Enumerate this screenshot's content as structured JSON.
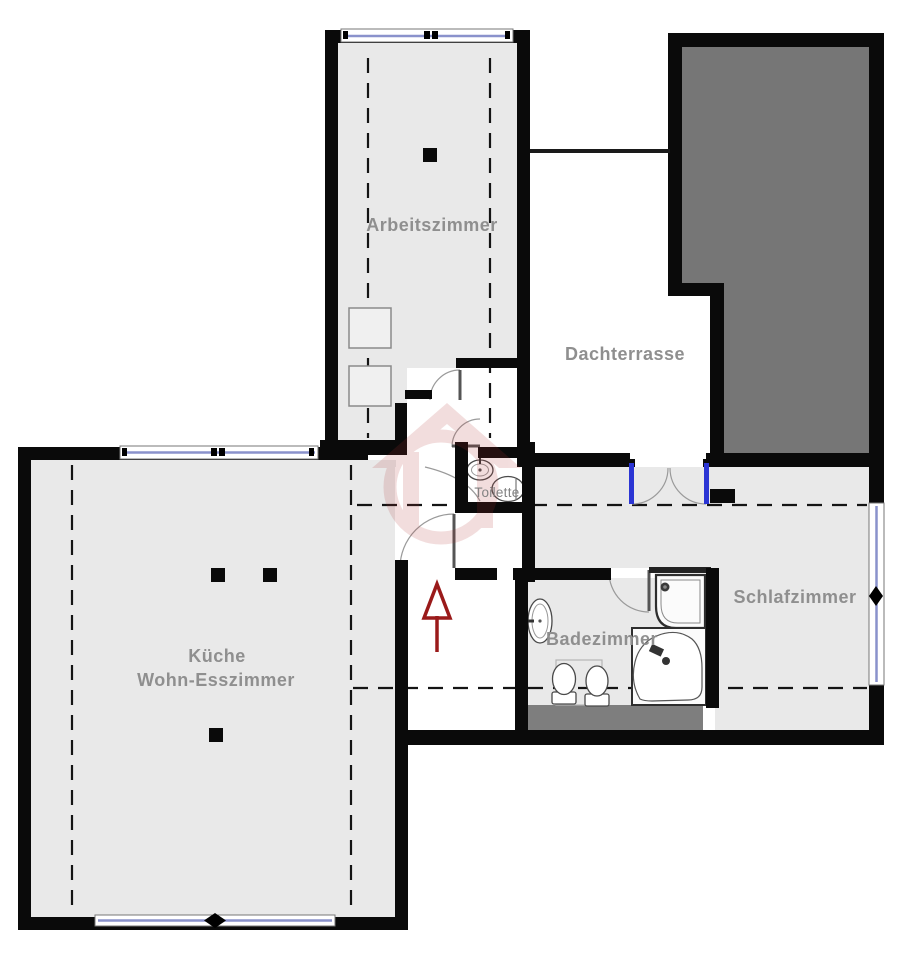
{
  "document_type": "apartment-floor-plan",
  "rooms": {
    "arbeitszimmer": {
      "label": "Arbeitszimmer"
    },
    "dachterrasse": {
      "label": "Dachterrasse"
    },
    "toilette": {
      "label": "Toilette"
    },
    "kueche_wohn_esszimmer": {
      "line1": "Küche",
      "line2": "Wohn-Esszimmer"
    },
    "badezimmer": {
      "label": "Badezimmer"
    },
    "schlafzimmer": {
      "label": "Schlafzimmer"
    }
  },
  "annotations": {
    "entrance_arrow_direction": "up"
  },
  "colors": {
    "wall": "#0a0a0a",
    "floor": "#e9e9e9",
    "roof_overhang_gray": "#767676",
    "shaft_gray": "#7e7e7e",
    "label_text": "#8f8f8f",
    "window_glazing_blue": "#8a92cc",
    "terrace_door_jamb_blue": "#2b35d4",
    "entrance_arrow_red": "#9a1a1a",
    "watermark_red": "#b23434"
  }
}
